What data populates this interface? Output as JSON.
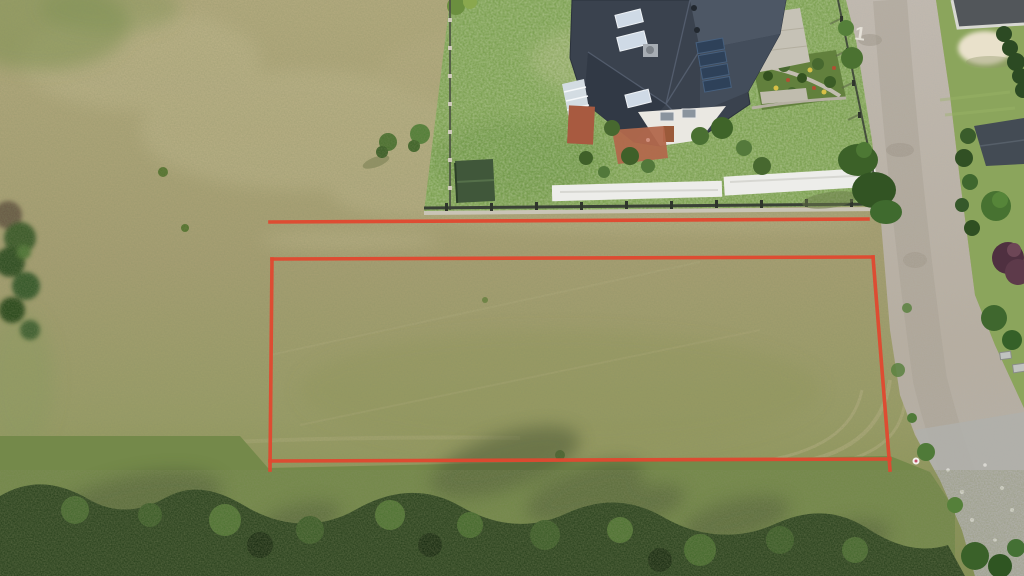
{
  "scene": {
    "description": "Aerial drone photo of a dry grass building plot outlined in red, next to a house with dark roof, a gravel road on the right and a tree line at the bottom",
    "boundary": {
      "color": "#e0482f",
      "top_offset_line": "270,222 868,219",
      "rect_top": "272,259 873,257",
      "rect_right": "873,257 890,470",
      "rect_bottom": "270,461 890,459",
      "rect_left": "272,259 270,470"
    },
    "road_marking": {
      "text": "1"
    }
  },
  "colors": {
    "red_line": "#e0482f",
    "field_pale": "#c6bd94",
    "lawn": "#7ea254",
    "east_grass": "#8ba55c",
    "roof": "#3a424e",
    "roof_light": "#4d5765",
    "roof_mid": "#434d5b",
    "roof_shadow": "#313945",
    "skylight": "#cfdae6",
    "solar": "#2e4159",
    "wall": "#eae8e2",
    "terracotta": "#b2684c",
    "brick": "#a85a40",
    "shed": "#40573a",
    "tarp": "#ededea",
    "fence": "#3a4136",
    "fence_base": "#c9c4b6",
    "road": "#b9b1a3",
    "gravel": "#b0b0ab",
    "sand": "#e9e1cb",
    "hedge": "#2c4a23",
    "tree": "#3f672e",
    "tree_light": "#538038",
    "tree_dark": "#2b431f",
    "purple_tree": "#543344",
    "shadow": "#4f5c39",
    "glass": "#d3dce2",
    "flat_roof": "#52565a",
    "marking": "#ece9e0"
  }
}
